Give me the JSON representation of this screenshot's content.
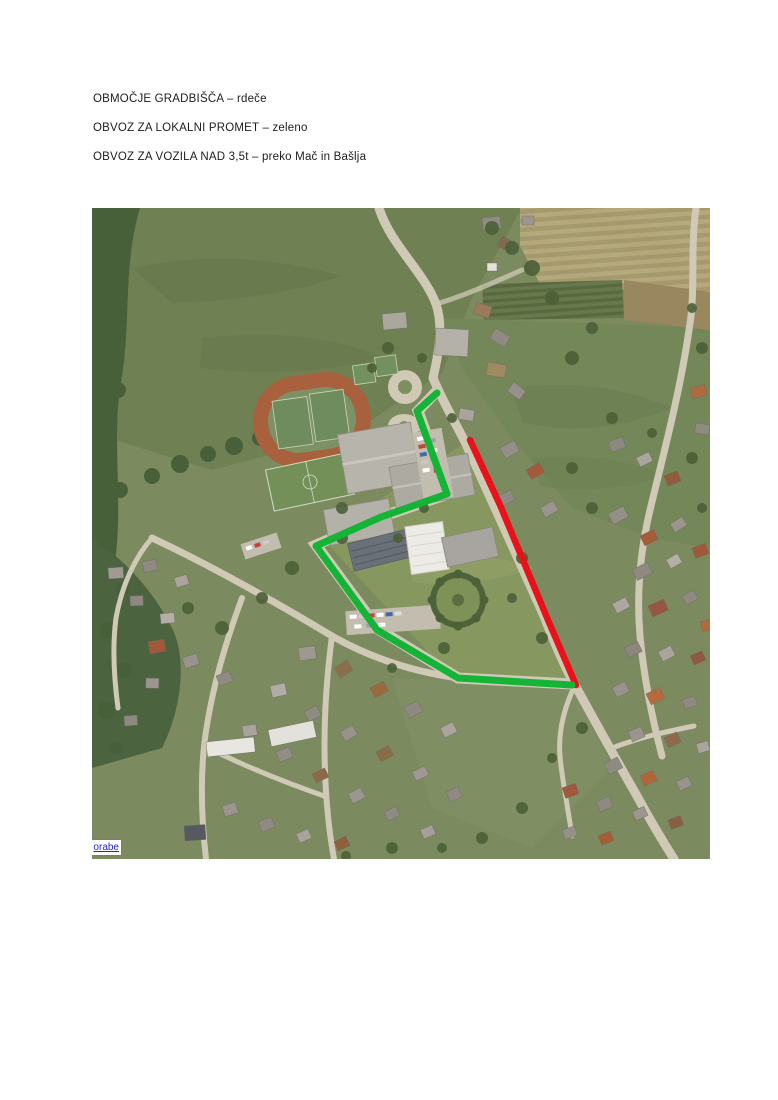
{
  "legend": {
    "lines": [
      {
        "text": "OBMOČJE GRADBIŠČA – rdeče"
      },
      {
        "text": "OBVOZ ZA LOKALNI PROMET – zeleno"
      },
      {
        "text": "OBVOZ ZA VOZILA NAD 3,5t – preko Mač in Bašlja"
      }
    ],
    "text_color": "#1c1c1c"
  },
  "map": {
    "watermark": {
      "text": "orabe",
      "link_color": "#2323cc"
    },
    "overlay_colors": {
      "construction_area_red": "#e9111a",
      "local_traffic_green": "#14b437"
    },
    "routes": [
      {
        "name": "construction-area-route-red",
        "color": "#e9111a",
        "width": 6.5,
        "points": [
          [
            378,
            232
          ],
          [
            408,
            297
          ],
          [
            456,
            412
          ],
          [
            484,
            477
          ]
        ]
      },
      {
        "name": "local-traffic-detour-route-green",
        "color": "#14b437",
        "width": 7,
        "points": [
          [
            345,
            185
          ],
          [
            325,
            203
          ],
          [
            355,
            286
          ],
          [
            289,
            309
          ],
          [
            224,
            338
          ],
          [
            285,
            422
          ],
          [
            366,
            470
          ],
          [
            480,
            477
          ]
        ]
      }
    ]
  }
}
